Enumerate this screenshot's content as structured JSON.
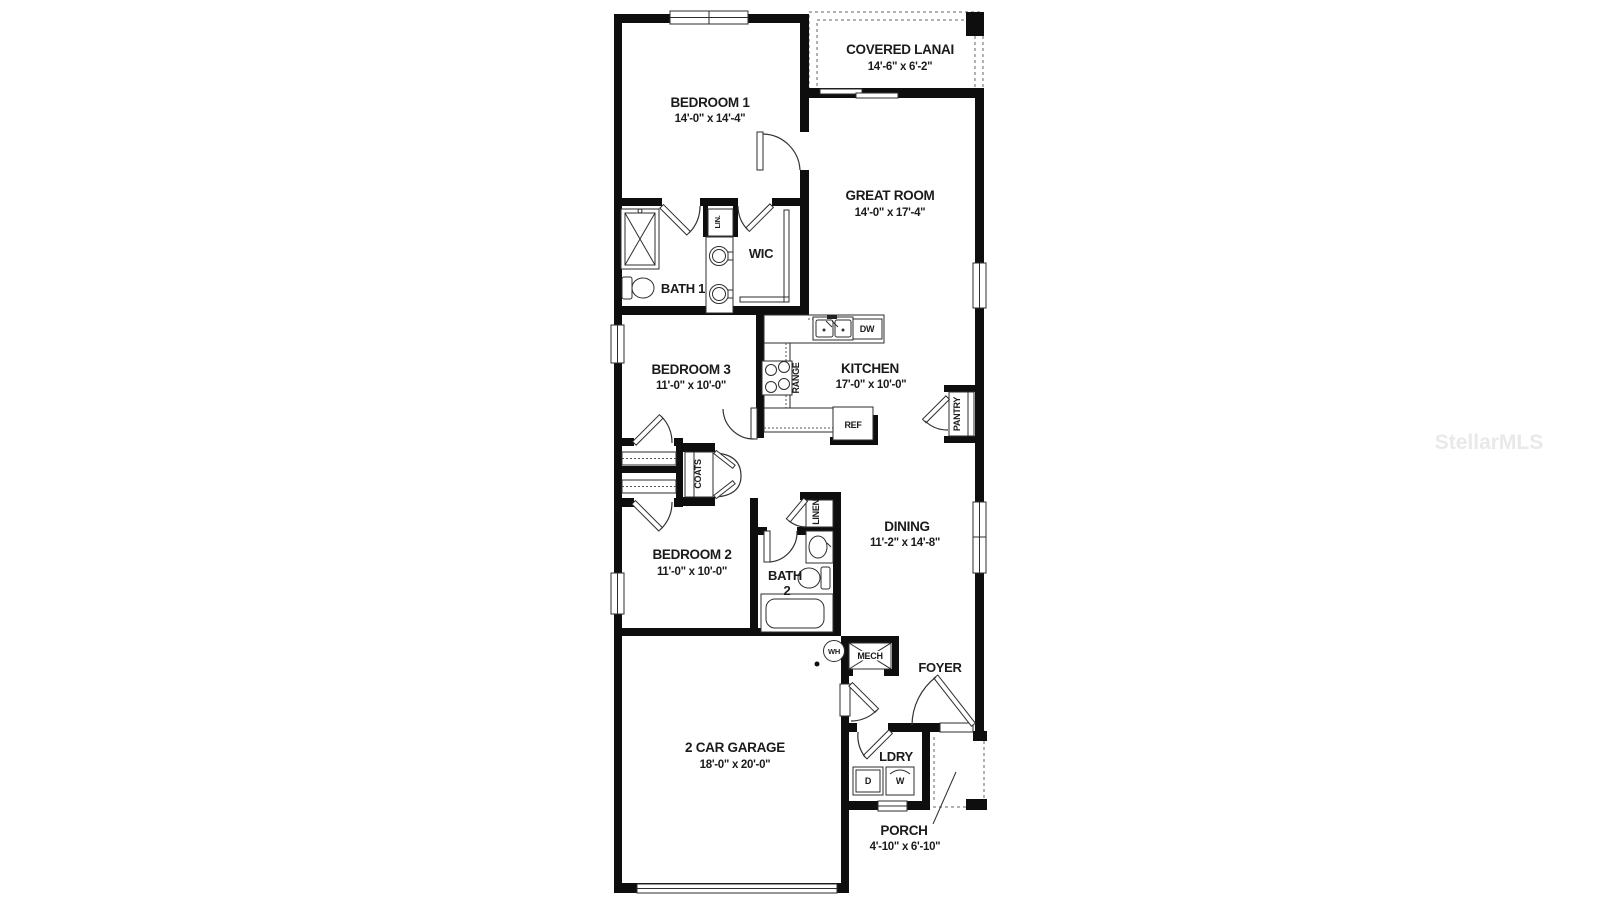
{
  "watermark": "StellarMLS",
  "plan": {
    "rooms": {
      "bedroom1": {
        "name": "BEDROOM 1",
        "dims": "14'-0\" x 14'-4\""
      },
      "covered_lanai": {
        "name": "COVERED LANAI",
        "dims": "14'-6\" x 6'-2\""
      },
      "great_room": {
        "name": "GREAT ROOM",
        "dims": "14'-0\" x 17'-4\""
      },
      "bath1": {
        "name": "BATH 1"
      },
      "wic": {
        "name": "WIC"
      },
      "bedroom3": {
        "name": "BEDROOM 3",
        "dims": "11'-0\" x 10'-0\""
      },
      "kitchen": {
        "name": "KITCHEN",
        "dims": "17'-0\" x 10'-0\""
      },
      "bedroom2": {
        "name": "BEDROOM 2",
        "dims": "11'-0\" x 10'-0\""
      },
      "bath2": {
        "name_line1": "BATH",
        "name_line2": "2"
      },
      "dining": {
        "name": "DINING",
        "dims": "11'-2\" x 14'-8\""
      },
      "foyer": {
        "name": "FOYER"
      },
      "laundry": {
        "name": "LDRY"
      },
      "garage": {
        "name": "2 CAR GARAGE",
        "dims": "18'-0\" x 20'-0\""
      },
      "porch": {
        "name": "PORCH",
        "dims": "4'-10\" x 6'-10\""
      }
    },
    "closets": {
      "lin": "LIN.",
      "coats": "COATS",
      "linen": "LINEN",
      "pantry": "PANTRY"
    },
    "labels": {
      "range": "RANGE",
      "dishwasher": "DW",
      "refrigerator": "REF",
      "dryer": "D",
      "washer": "W",
      "water_heater": "WH",
      "mechanical": "MECH"
    }
  }
}
